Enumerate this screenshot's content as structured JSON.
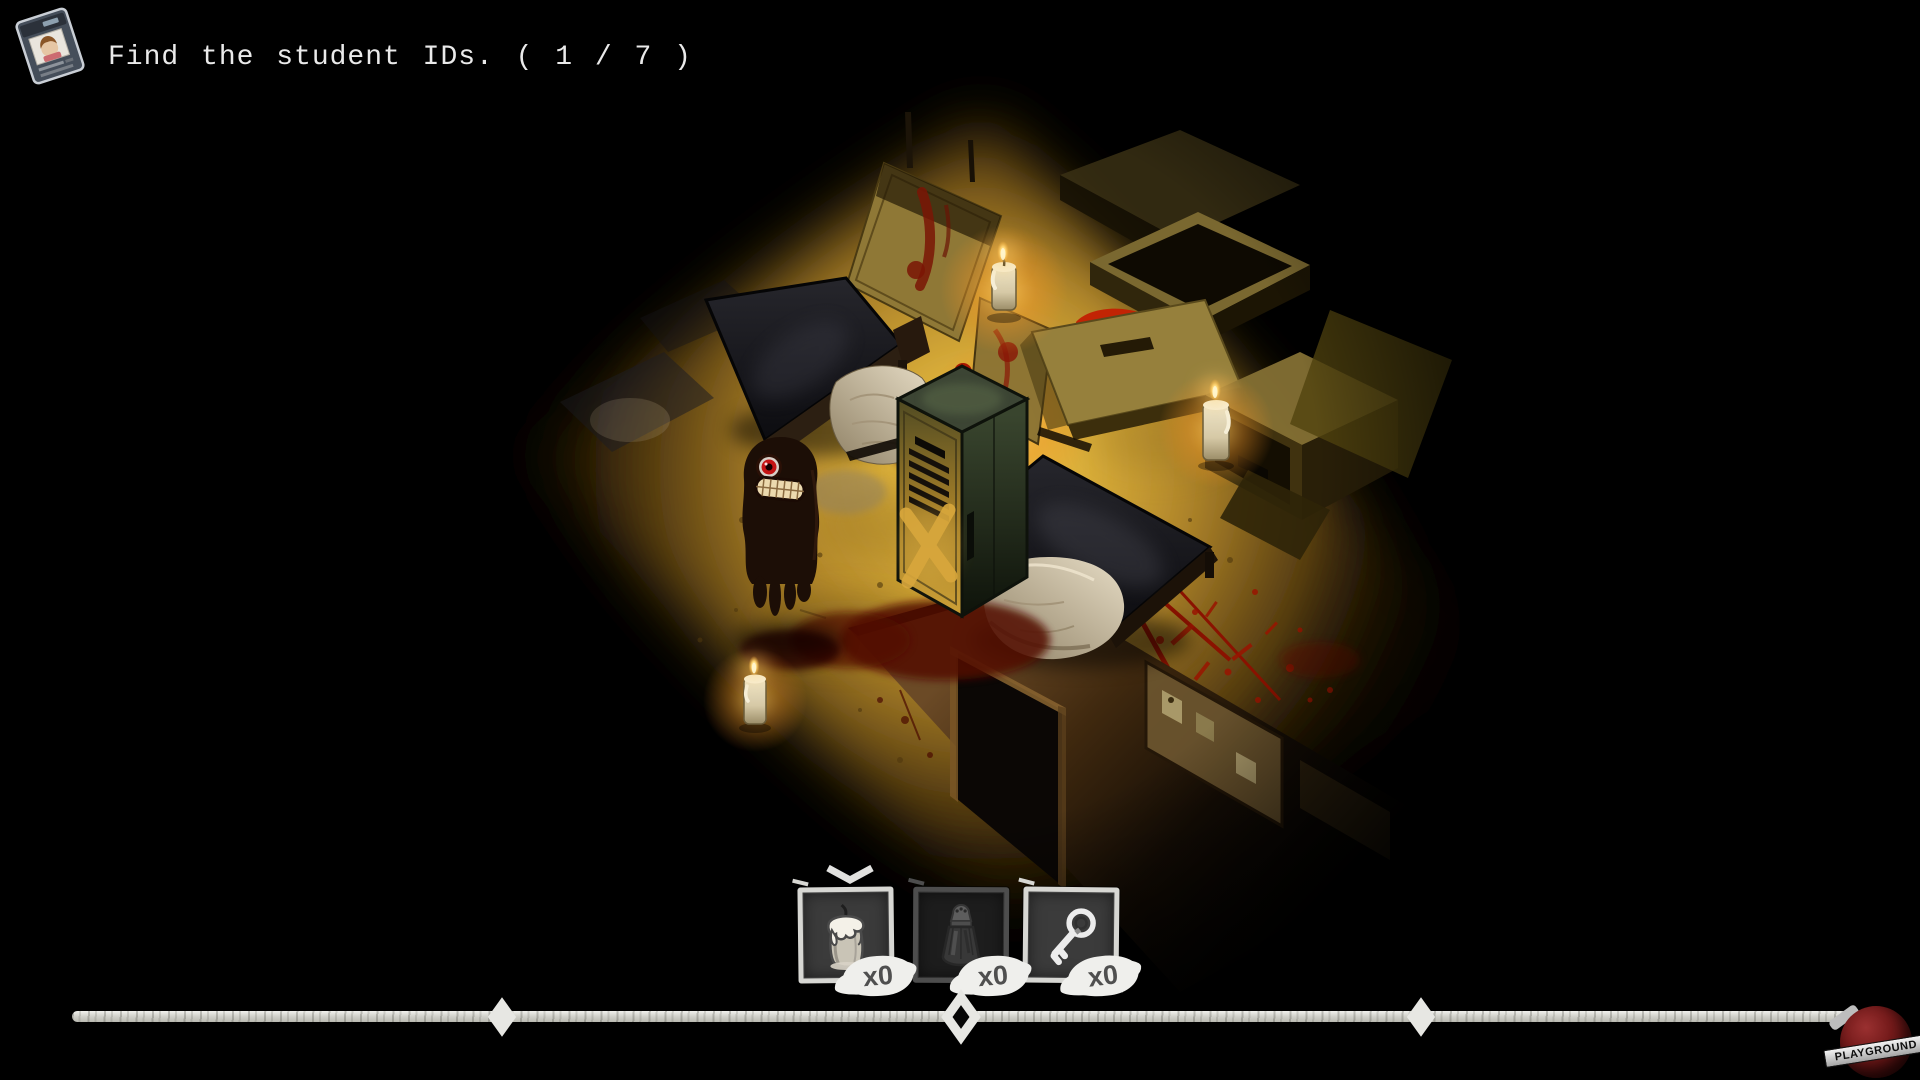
{
  "hud": {
    "quest": {
      "icon": "student-id-card-icon",
      "text": "Find the student IDs. ( 1 / 7 )"
    }
  },
  "inventory": {
    "selected_slot_index": 0,
    "slots": [
      {
        "item": "candle",
        "icon": "candle-icon",
        "count_label": "x0",
        "enabled": true,
        "selected": true
      },
      {
        "item": "salt-shaker",
        "icon": "salt-shaker-icon",
        "count_label": "x0",
        "enabled": false,
        "selected": false
      },
      {
        "item": "key",
        "icon": "key-icon",
        "count_label": "x0",
        "enabled": true,
        "selected": false
      }
    ]
  },
  "timeline": {
    "marker_count": 3,
    "marker_style": "diamond"
  },
  "watermark": {
    "label": "PLAYGROUND"
  },
  "scene": {
    "objects": [
      "metal-bed-with-white-sheet",
      "second-bed-with-pillow",
      "green-locker-with-x-mark",
      "one-eyed-shadow-monster",
      "lit-candles",
      "blood-pool-and-spatter",
      "cardboard-boxes",
      "wooden-door-panel",
      "wall-with-doorframe-and-notice-board"
    ],
    "palette": {
      "background": "#000000",
      "floor_light": "#ddb13a",
      "glow": "#f2c24a",
      "blood": "#b01a00",
      "locker_green": "#3c4534",
      "monster_body": "#1c0e06",
      "monster_eye": "#c41414"
    }
  }
}
